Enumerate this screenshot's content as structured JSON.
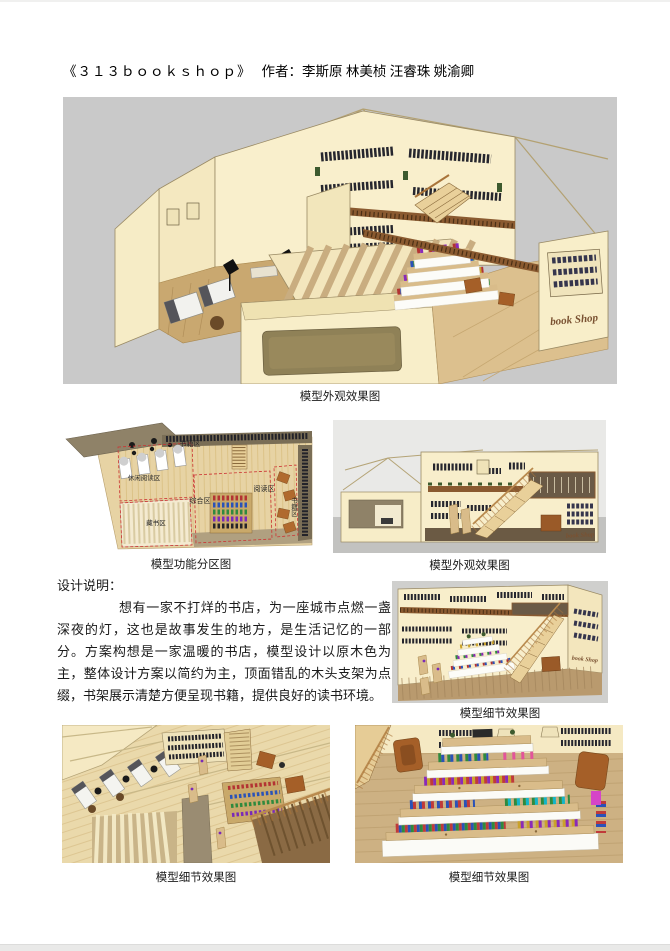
{
  "page": {
    "title": "《３１３ｂｏｏｋｓｈｏｐ》",
    "authors": "作者：李斯原 林美桢 汪睿珠 姚渝卿"
  },
  "brand": {
    "sign": "book Shop"
  },
  "figures": {
    "main": {
      "caption": "模型外观效果图"
    },
    "plan": {
      "caption": "模型功能分区图",
      "zones": {
        "top": "书籍区",
        "left": "休闲阅读区",
        "storage": "藏书区",
        "center": "综合区",
        "reading": "阅读区",
        "right_vertical": "书籍区"
      }
    },
    "elevation": {
      "caption": "模型外观效果图"
    },
    "detail_mid": {
      "caption": "模型细节效果图"
    },
    "detail_left": {
      "caption": "模型细节效果图"
    },
    "detail_right": {
      "caption": "模型细节效果图"
    }
  },
  "description": {
    "heading": "设计说明：",
    "body": "想有一家不打烊的书店，为一座城市点燃一盏深夜的灯，这也是故事发生的地方，是生活记忆的一部分。方案构想是一家温暖的书店，模型设计以原木色为主，整体设计方案以简约为主，顶面错乱的木头支架为点缀，书架展示清楚方便呈现书籍，提供良好的读书环境。"
  },
  "colors": {
    "wall_cream": "#f8eecb",
    "wood_tan": "#d9bc8a",
    "canvas_grey": "#c9c9c9",
    "railing_brown": "#8a5a30",
    "zone_dash_red": "#cc3333",
    "book_dark": "#26262e"
  }
}
